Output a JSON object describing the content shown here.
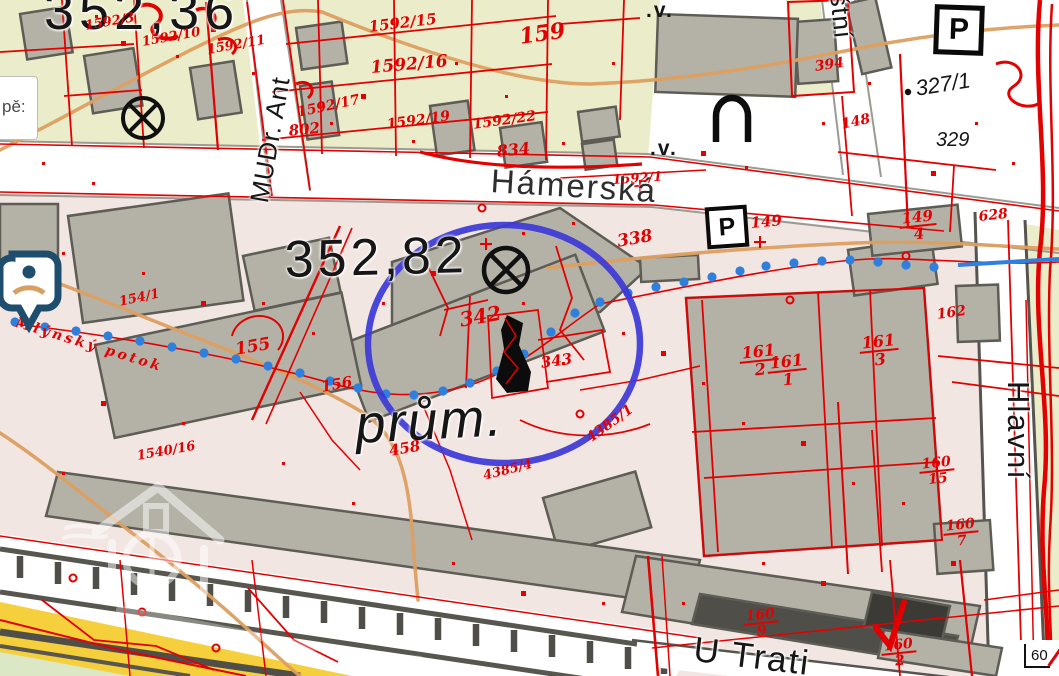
{
  "map": {
    "tooltip_fragment": "pě:",
    "scale_value": "60",
    "streets": {
      "hamerska": "Hámerská",
      "u_trati": "U Trati",
      "hlavni": "Hlavní",
      "mudr": "MUDr. Ant",
      "stni": "štní"
    },
    "elevations": {
      "e1": "352,36",
      "e2": "352,82"
    },
    "area_label": "prům.",
    "water_label": "Mlýnský potok",
    "printed_parcels": {
      "p327": "327/1",
      "p329": "329"
    },
    "vegetation_mark": ".v.",
    "parking_symbol": "P",
    "red_labels": {
      "r1": "1592/3",
      "r2": "1592/10",
      "r3": "1592/11",
      "r4": "1592/15",
      "r5": "1592/16",
      "r6": "1592/17",
      "r7": "802",
      "r8": "1592/19",
      "r9": "1592/22",
      "r10": "834",
      "r11": "159",
      "r12": "1592/1",
      "r13": "338",
      "r14": "394",
      "r15": "148",
      "r16": "342",
      "r17": "343",
      "r18": "155",
      "r19": "156",
      "r20": "154/1",
      "r21": "458",
      "r22": "4385/1",
      "r23": "4385/4",
      "r24": "1540/16",
      "r25": "628",
      "r26": "149",
      "r27": "162"
    },
    "fractions": {
      "f1": {
        "n": "149",
        "d": "4"
      },
      "f2": {
        "n": "161",
        "d": "2"
      },
      "f3": {
        "n": "161",
        "d": "1"
      },
      "f4": {
        "n": "161",
        "d": "3"
      },
      "f5": {
        "n": "160",
        "d": "15"
      },
      "f6": {
        "n": "160",
        "d": "7"
      },
      "f7": {
        "n": "160",
        "d": "9"
      },
      "f8": {
        "n": "160",
        "d": "2"
      }
    },
    "icons": {
      "poi_pin": "map-pin-icon",
      "crossed_circle": "⊗",
      "arch_symbol": "∩"
    },
    "colors": {
      "cadastral_red": "#e30000",
      "highlight_blue": "#3c38d8",
      "water_blue": "#2f7fdd",
      "contour_orange": "#dd9f60",
      "parcel_yellow": "#ebecc9",
      "industrial_pink": "#f2e6e3",
      "building_gray": "#b4b2a7"
    }
  }
}
